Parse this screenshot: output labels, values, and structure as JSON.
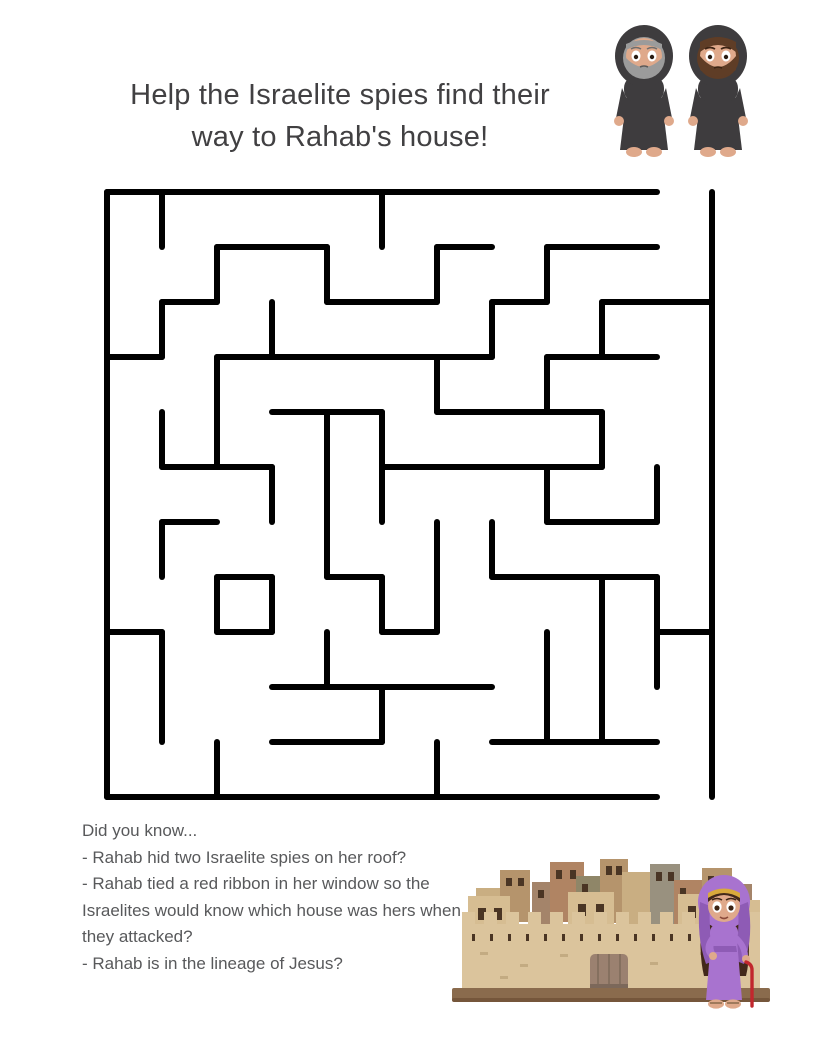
{
  "title": {
    "line1": "Help the Israelite spies find their",
    "line2": "way to Rahab's house!"
  },
  "facts": {
    "heading": "Did you know...",
    "items": [
      "- Rahab hid two Israelite spies on her roof?",
      "- Rahab tied a red ribbon in her window so the Israelites would know which house was hers when they attacked?",
      "- Rahab is in the lineage of Jesus?"
    ]
  },
  "maze": {
    "x": 107,
    "y": 192,
    "cell": 55,
    "cols": 11,
    "rows": 11,
    "stroke": "#000000",
    "stroke_width": 6,
    "entrance": {
      "side": "top",
      "col": 10
    },
    "exit": {
      "side": "bottom",
      "col": 10
    },
    "h_walls": [
      [
        0,
        0,
        10
      ],
      [
        1,
        2,
        4
      ],
      [
        1,
        6,
        7
      ],
      [
        1,
        8,
        10
      ],
      [
        2,
        1,
        2
      ],
      [
        2,
        4,
        6
      ],
      [
        2,
        7,
        8
      ],
      [
        2,
        9,
        11
      ],
      [
        3,
        0,
        1
      ],
      [
        3,
        2,
        7
      ],
      [
        3,
        8,
        10
      ],
      [
        4,
        3,
        5
      ],
      [
        4,
        6,
        9
      ],
      [
        5,
        1,
        3
      ],
      [
        5,
        5,
        9
      ],
      [
        6,
        1,
        2
      ],
      [
        6,
        8,
        10
      ],
      [
        7,
        2,
        3
      ],
      [
        7,
        4,
        5
      ],
      [
        7,
        7,
        10
      ],
      [
        8,
        0,
        1
      ],
      [
        8,
        2,
        3
      ],
      [
        8,
        5,
        6
      ],
      [
        8,
        10,
        11
      ],
      [
        9,
        3,
        7
      ],
      [
        10,
        3,
        5
      ],
      [
        10,
        7,
        10
      ],
      [
        11,
        0,
        10
      ]
    ],
    "v_walls": [
      [
        0,
        0,
        11
      ],
      [
        1,
        0,
        1
      ],
      [
        1,
        2,
        3
      ],
      [
        1,
        4,
        5
      ],
      [
        1,
        6,
        7
      ],
      [
        1,
        8,
        10
      ],
      [
        2,
        1,
        2
      ],
      [
        2,
        3,
        5
      ],
      [
        2,
        7,
        8
      ],
      [
        2,
        10,
        11
      ],
      [
        3,
        2,
        3
      ],
      [
        3,
        5,
        6
      ],
      [
        3,
        7,
        8
      ],
      [
        4,
        1,
        2
      ],
      [
        4,
        4,
        7
      ],
      [
        4,
        8,
        9
      ],
      [
        5,
        0,
        1
      ],
      [
        5,
        4,
        6
      ],
      [
        5,
        7,
        8
      ],
      [
        5,
        9,
        10
      ],
      [
        6,
        1,
        2
      ],
      [
        6,
        3,
        4
      ],
      [
        6,
        6,
        8
      ],
      [
        6,
        10,
        11
      ],
      [
        7,
        2,
        3
      ],
      [
        7,
        6,
        7
      ],
      [
        8,
        1,
        2
      ],
      [
        8,
        3,
        4
      ],
      [
        8,
        5,
        6
      ],
      [
        8,
        8,
        10
      ],
      [
        9,
        2,
        3
      ],
      [
        9,
        4,
        5
      ],
      [
        9,
        7,
        10
      ],
      [
        10,
        5,
        6
      ],
      [
        10,
        7,
        9
      ],
      [
        11,
        0,
        11
      ]
    ]
  },
  "illustrations": {
    "spies": "two Israelite spies in dark hooded robes, one gray-bearded, one brown-bearded",
    "city": "walled city of Jericho in tan stone with gate and rooftop houses",
    "rahab": "Rahab in purple veil and dress holding a red cord"
  },
  "palette": {
    "ink_title": "#414042",
    "ink_body": "#58595b",
    "maze_stroke": "#000000",
    "robe": "#3e3c3e",
    "robe_dark": "#2f2d2f",
    "skin": "#dfa98b",
    "skin_light": "#ecc3a6",
    "beard_gray": "#9b9b9b",
    "beard_brown": "#5f3d26",
    "purple": "#a873cf",
    "purple_dark": "#8e5bb5",
    "gold": "#d9a93c",
    "hair_brown": "#42281a",
    "cord_red": "#c1272d",
    "wall_tan": "#dbc49c",
    "wall_shadow": "#c4ab7e",
    "base_brown": "#8a6b4d",
    "base_dark": "#75563b",
    "door": "#9b8170",
    "door_dark": "#7c685a",
    "window": "#4a3524",
    "bld_tan": "#c9ae82",
    "bld_brown": "#b5946c",
    "bld_dark": "#a4846a",
    "bld_light": "#d6bd92",
    "bld_olive": "#8f8668",
    "bld_gray": "#99917f",
    "bld_red": "#b08463"
  }
}
